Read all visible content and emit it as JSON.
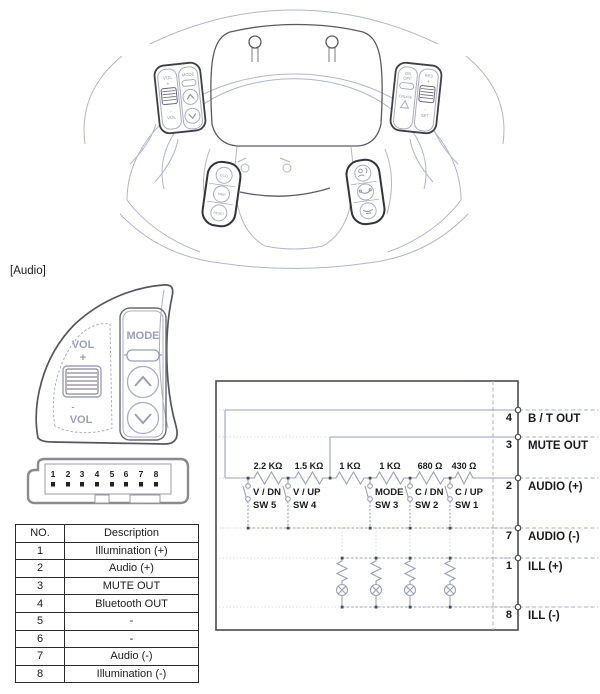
{
  "wheel": {
    "audio_cluster": {
      "vol": "VOL",
      "plus": "+",
      "minus": "-",
      "mode": "MODE"
    },
    "cruise_cluster": {
      "on": "ON",
      "off": "OFF",
      "cruise": "CRUISE",
      "res": "RES",
      "plus": "+",
      "minus": "-",
      "set": "SET"
    },
    "trip_pod": {
      "eco": "ECO",
      "trip": "TRIP",
      "reset": "RESET"
    }
  },
  "audio_detail": {
    "label": "[Audio]",
    "vol": "VOL",
    "plus": "+",
    "minus": "-",
    "mode": "MODE"
  },
  "connector": {
    "pins": [
      "1",
      "2",
      "3",
      "4",
      "5",
      "6",
      "7",
      "8"
    ]
  },
  "pin_table": {
    "headers": {
      "no": "NO.",
      "description": "Description"
    },
    "rows": [
      {
        "no": "1",
        "description": "Illumination (+)"
      },
      {
        "no": "2",
        "description": "Audio (+)"
      },
      {
        "no": "3",
        "description": "MUTE OUT"
      },
      {
        "no": "4",
        "description": "Bluetooth OUT"
      },
      {
        "no": "5",
        "description": "-"
      },
      {
        "no": "6",
        "description": "-"
      },
      {
        "no": "7",
        "description": "Audio (-)"
      },
      {
        "no": "8",
        "description": "Illumination (-)"
      }
    ]
  },
  "schematic": {
    "resistors": [
      "2.2 KΩ",
      "1.5 KΩ",
      "1 KΩ",
      "1 KΩ",
      "680 Ω",
      "430 Ω"
    ],
    "switches": [
      {
        "func": "V / DN",
        "name": "SW 5"
      },
      {
        "func": "V / UP",
        "name": "SW 4"
      },
      {
        "func": "MODE",
        "name": "SW 3"
      },
      {
        "func": "C / DN",
        "name": "SW 2"
      },
      {
        "func": "C / UP",
        "name": "SW 1"
      }
    ],
    "pins": [
      {
        "num": "4",
        "label": "B / T OUT"
      },
      {
        "num": "3",
        "label": "MUTE OUT"
      },
      {
        "num": "2",
        "label": "AUDIO (+)"
      },
      {
        "num": "7",
        "label": "AUDIO (-)"
      },
      {
        "num": "1",
        "label": "ILL (+)"
      },
      {
        "num": "8",
        "label": "ILL (-)"
      }
    ],
    "colors": {
      "circuit_line": "#9aa0b8",
      "outline": "#4a4a52",
      "text": "#1a1a1a"
    }
  }
}
